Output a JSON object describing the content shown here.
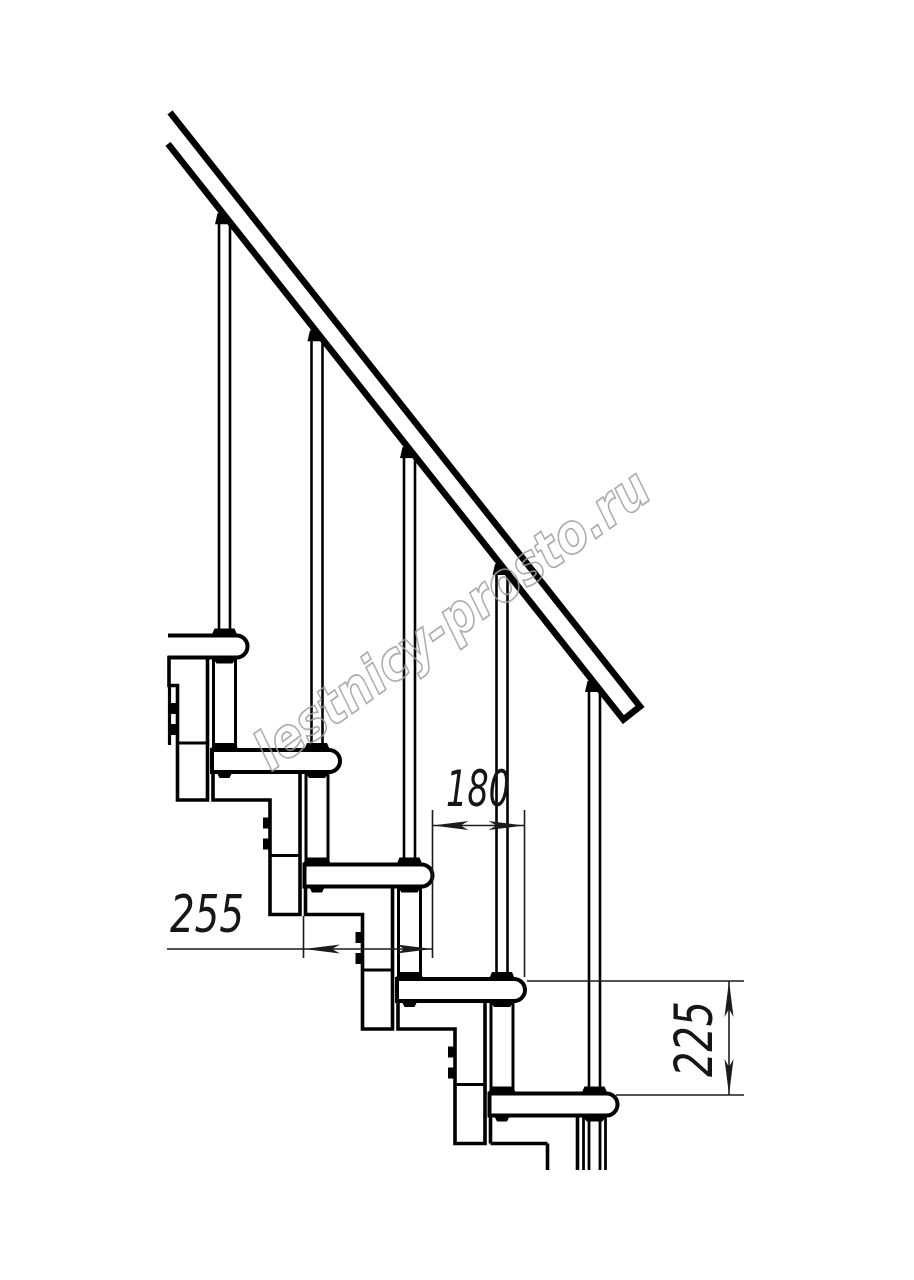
{
  "drawing": {
    "title": "modular-staircase-side-elevation",
    "dimensions": {
      "tread_depth": "255",
      "step_run": "180",
      "step_rise": "225"
    },
    "watermark": "lestnicy-prosto.ru",
    "colors": {
      "line": "#000000",
      "dimension_line": "#1c1c1c",
      "watermark": "#9e9e9e",
      "background": "#ffffff"
    }
  }
}
